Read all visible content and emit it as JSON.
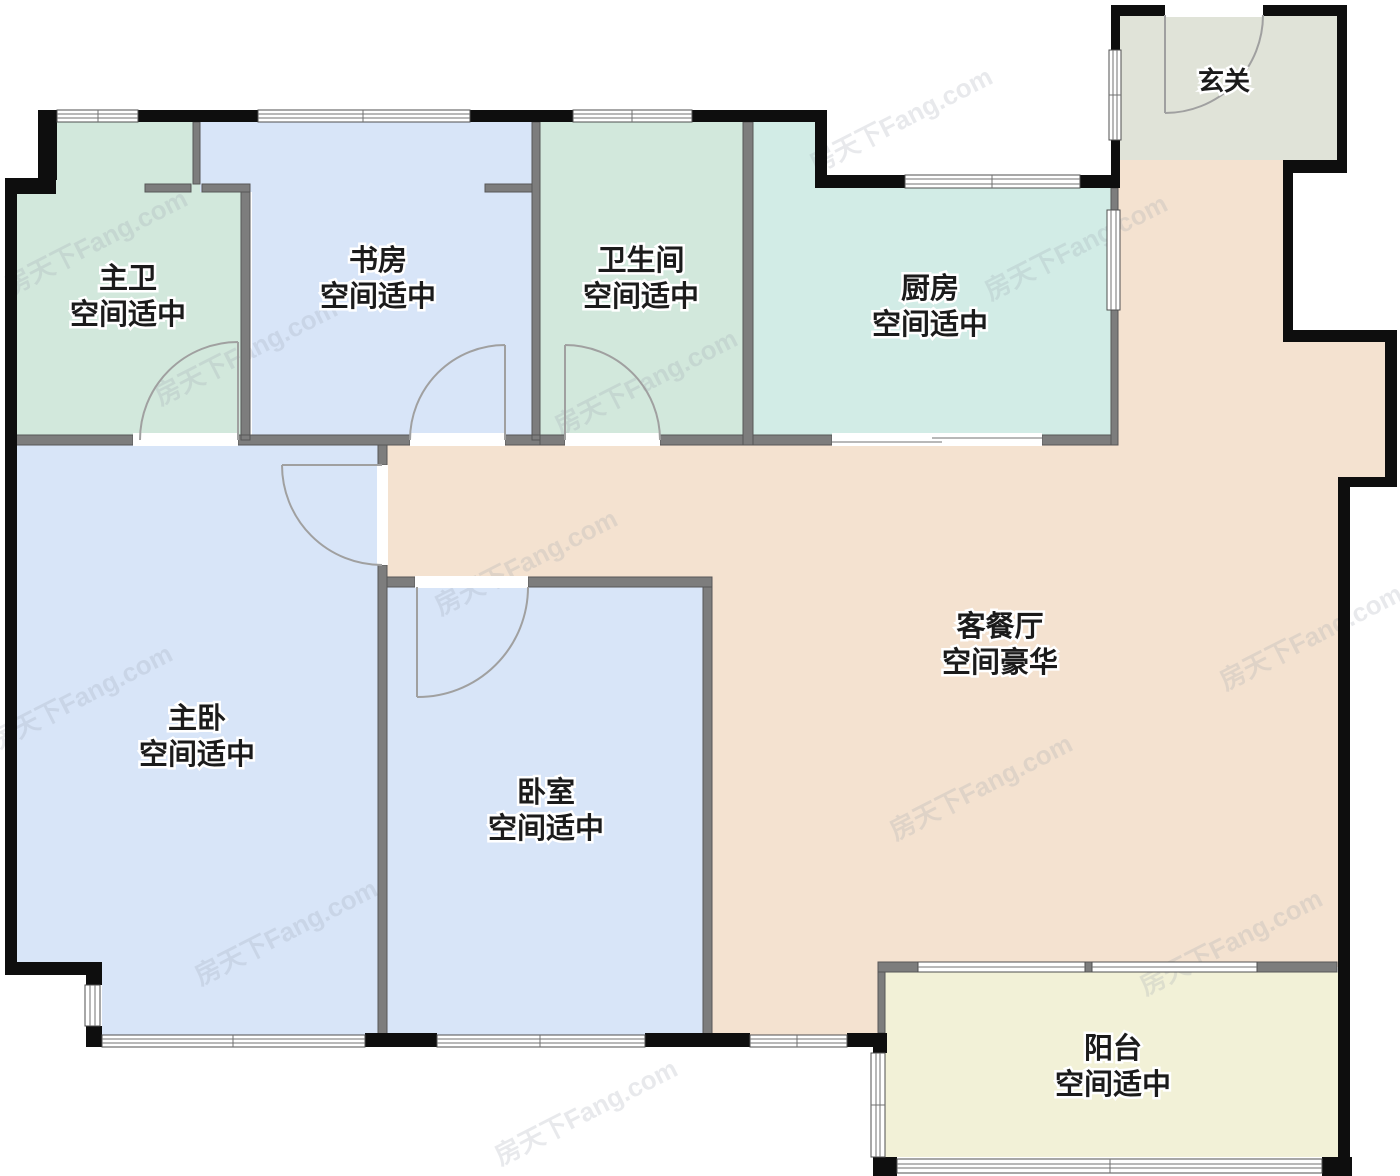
{
  "plan": {
    "watermark": "房天下Fang.com",
    "rooms": [
      {
        "id": "master-bath",
        "name": "主卫",
        "desc": "空间适中",
        "color": "#d2e8dc"
      },
      {
        "id": "study",
        "name": "书房",
        "desc": "空间适中",
        "color": "#d8e5f8"
      },
      {
        "id": "bathroom",
        "name": "卫生间",
        "desc": "空间适中",
        "color": "#d2e8dc"
      },
      {
        "id": "kitchen",
        "name": "厨房",
        "desc": "空间适中",
        "color": "#d2ece6"
      },
      {
        "id": "entry",
        "name": "玄关",
        "desc": "",
        "color": "#e0e3d8"
      },
      {
        "id": "master-bedroom",
        "name": "主卧",
        "desc": "空间适中",
        "color": "#d8e5f8"
      },
      {
        "id": "bedroom",
        "name": "卧室",
        "desc": "空间适中",
        "color": "#d8e5f8"
      },
      {
        "id": "living-dining",
        "name": "客餐厅",
        "desc": "空间豪华",
        "color": "#f4e2d0"
      },
      {
        "id": "balcony",
        "name": "阳台",
        "desc": "空间适中",
        "color": "#f2f1d7"
      }
    ],
    "colors": {
      "wall_black": "#0e0e0e",
      "wall_gray": "#7d7d7d",
      "door_arc": "#a0a0a0",
      "label_text": "#1b1b1b"
    }
  }
}
